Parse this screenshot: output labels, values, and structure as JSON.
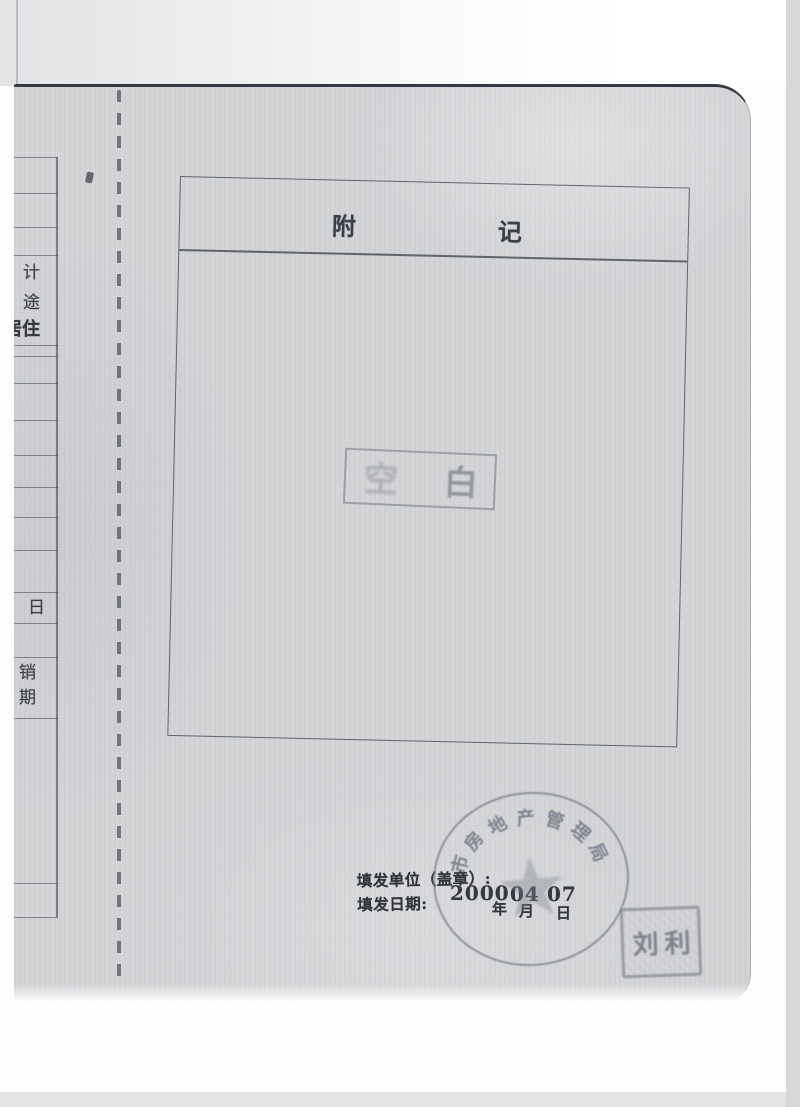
{
  "notes_box": {
    "title_left": "附",
    "title_right": "记"
  },
  "blank_stamp": {
    "char_left": "空",
    "char_right": "白"
  },
  "footer": {
    "issuing_unit_label": "填发单位（盖章）:",
    "issue_date_label": "填发日期:",
    "date_year": "2000",
    "date_month": "04",
    "date_day": "07",
    "unit_year": "年",
    "unit_month": "月",
    "unit_day": "日"
  },
  "seals": {
    "round_seal_text": "市房地产管理局",
    "round_seal_star": "★",
    "name_seal_text": "刘利"
  },
  "left_page_fragments": [
    {
      "text": "计"
    },
    {
      "text": "途"
    },
    {
      "text": "居住"
    },
    {
      "text": "日"
    },
    {
      "text": "销"
    },
    {
      "text": "期"
    }
  ],
  "colors": {
    "paper": "#d2d4d6",
    "ink": "#33383e",
    "stamp_gray": "#767d86",
    "page_edge": "#353a40"
  }
}
